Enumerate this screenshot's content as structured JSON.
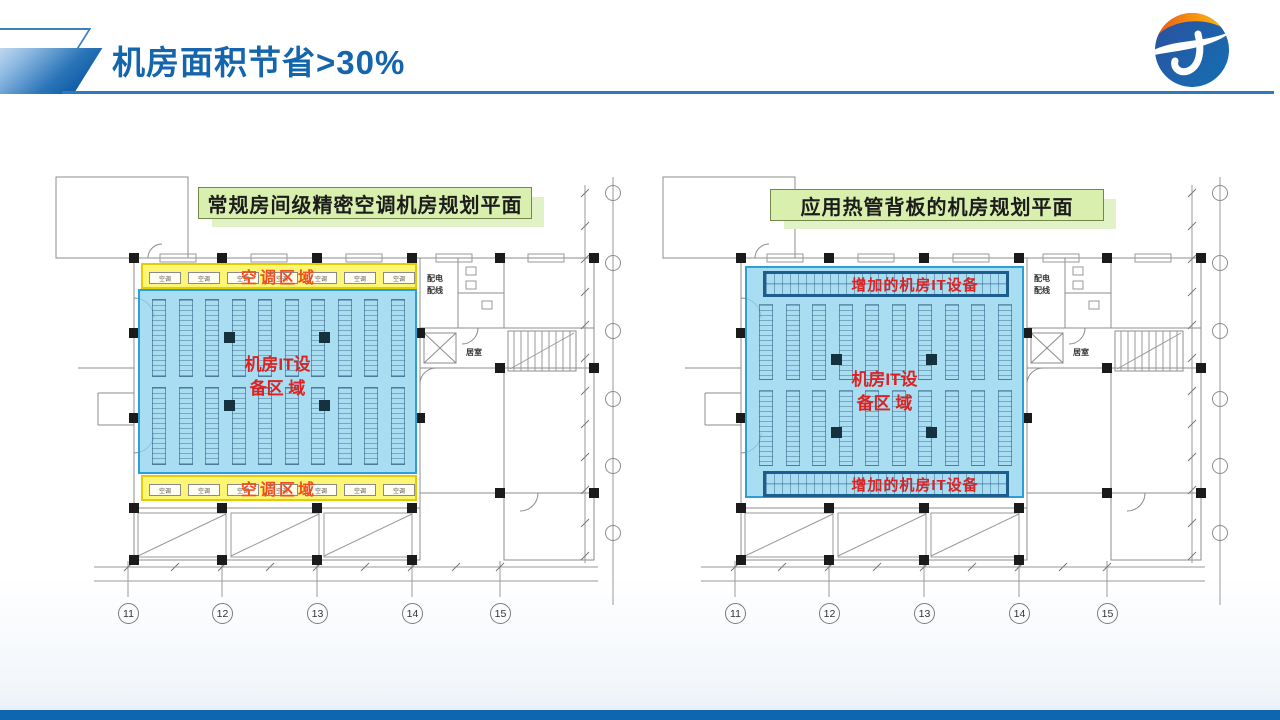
{
  "header": {
    "title": "机房面积节省>30%",
    "title_color": "#1565ad",
    "rule_color": "#2e79bd"
  },
  "logo": {
    "top_color": "#f9a01b",
    "accent_color": "#e8531a",
    "bottom_color": "#1a5fa8",
    "swoosh_color": "#ffffff"
  },
  "footer": {
    "bar_color": "#0e67ae"
  },
  "left_plan": {
    "title": "常规房间级精密空调机房规划平面",
    "ac_zone_top_label": "空调区域",
    "ac_zone_bottom_label": "空调区域",
    "ac_unit_label": "空调",
    "it_zone_line1": "机房IT设",
    "it_zone_line2": "备区 域",
    "room_power_line1": "配电",
    "room_power_line2": "配线",
    "room_duty_label": "居室",
    "axis_numbers": [
      "11",
      "12",
      "13",
      "14",
      "15"
    ],
    "zone_colors": {
      "ac_zone_fill": "#fdf469",
      "ac_zone_border": "#e3cc00",
      "ac_label_color": "#f04e1e",
      "it_zone_fill": "#8fd3ee",
      "it_zone_border": "#2a9fd8",
      "it_label_color": "#dd2222"
    }
  },
  "right_plan": {
    "title": "应用热管背板的机房规划平面",
    "added_it_top_label": "增加的机房IT设备",
    "added_it_bottom_label": "增加的机房IT设备",
    "it_zone_line1": "机房IT设",
    "it_zone_line2": "备区 域",
    "room_power_line1": "配电",
    "room_power_line2": "配线",
    "room_duty_label": "居室",
    "axis_numbers": [
      "11",
      "12",
      "13",
      "14",
      "15"
    ],
    "zone_colors": {
      "it_zone_fill": "#8fd3ee",
      "it_zone_border": "#2a9fd8",
      "added_box_border": "#1c5e8d",
      "it_label_color": "#dd2222"
    }
  },
  "plan_label_box": {
    "fill": "#d9efad",
    "border": "#75864a",
    "shadow": "#e1f3c6"
  }
}
